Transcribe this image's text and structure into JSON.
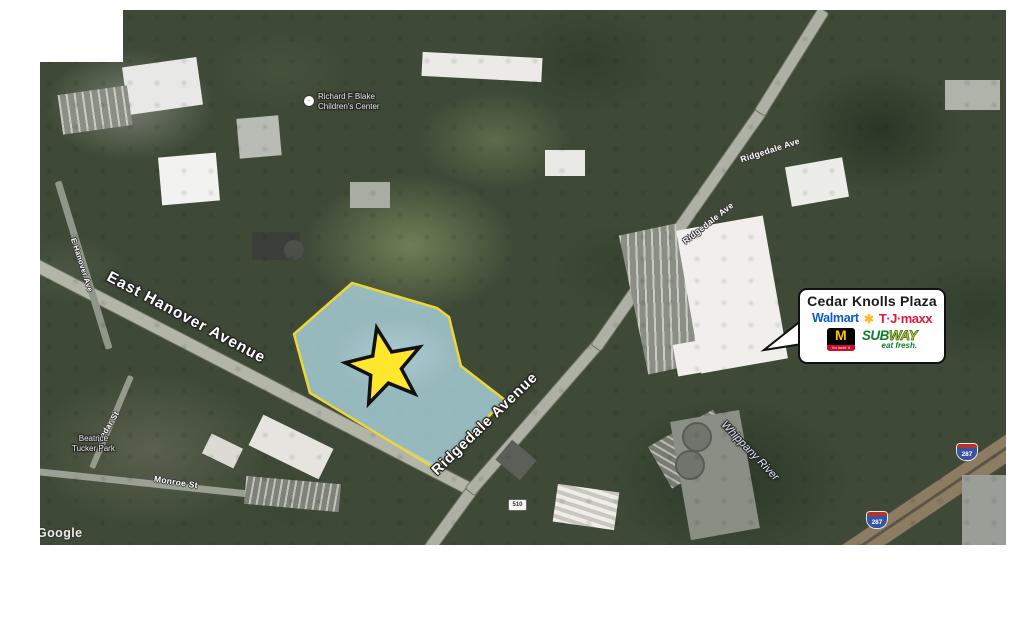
{
  "map": {
    "attribution": "Google",
    "street_labels": {
      "east_hanover_avenue": "East Hanover Avenue",
      "ridgedale_avenue": "Ridgedale Avenue",
      "ridgedale_ave_small_1": "Ridgedale Ave",
      "ridgedale_ave_small_2": "Ridgedale Ave",
      "hanover_ave_small": "E Hanover Ave",
      "monroe_st": "Monroe St",
      "cedar_st": "Cedar St"
    },
    "place_labels": {
      "whippany_river": "Whippany River",
      "beatrice_tucker_park_line1": "Beatrice",
      "beatrice_tucker_park_line2": "Tucker Park",
      "childrens_center_line1": "Richard F Blake",
      "childrens_center_line2": "Children's Center"
    },
    "shields": {
      "interstate_a": "287",
      "interstate_b": "287",
      "county_route": "510"
    }
  },
  "site": {
    "parcel_fill": "#afd5e0",
    "parcel_border": "#ecd63a",
    "star_fill": "#ffe72e"
  },
  "callout": {
    "title": "Cedar Knolls Plaza",
    "walmart_wordmark": "Walmart",
    "walmart_spark": "✱",
    "tjmaxx_wordmark": "T·J·maxx",
    "mcdonalds_m": "M",
    "mcdonalds_tagline": "i'm lovin' it",
    "subway_sub": "SUB",
    "subway_way": "WAY",
    "subway_tagline": "eat fresh.",
    "brand_colors": {
      "walmart_blue": "#0a5bc4",
      "walmart_yellow": "#fdbb30",
      "tjmaxx_red": "#e21836",
      "mcdonalds_yellow": "#ffc300",
      "subway_green": "#127a2d",
      "subway_yellow": "#fec20f"
    }
  }
}
